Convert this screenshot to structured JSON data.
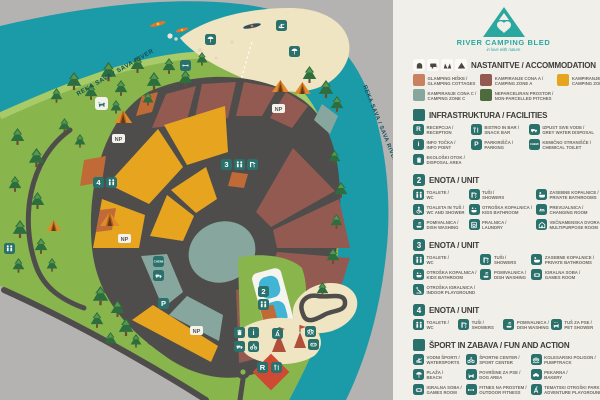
{
  "colors": {
    "gray": "#b5b3b1",
    "river": "#1b9aa8",
    "land": "#88b64c",
    "landlight": "#a6cb68",
    "sand": "#f0e5c3",
    "road": "#4e4d4b",
    "zonea": "#935a51",
    "zoneb": "#e7a51f",
    "zonec": "#87a79e",
    "glamping": "#c9815f",
    "nonparcelled": "#4e6b3d",
    "orangep": "#c06a38",
    "buildingred": "#ce4a33",
    "pool": "#43b5d4",
    "accent": "#2a716c",
    "legendbg": "#f1efe9",
    "header": "#3e3c38",
    "label": "#6f6b63",
    "treedark": "#2d6e3e",
    "treemid": "#57984d",
    "logo": "#2aa8a0",
    "riverlabel": "#0f4f5c"
  },
  "logo": {
    "title": "RIVER CAMPING BLED",
    "tagline": "in love with nature"
  },
  "map": {
    "river_label": "REKA SAVA / SAVA RIVER",
    "np": "NP",
    "markers": {
      "unit2": "2",
      "unit3": "3",
      "unit4": "4",
      "reception": "R",
      "parking": "P",
      "info": "i",
      "chemical": "CHEMI"
    }
  },
  "legend": {
    "accommodation": {
      "title": "NASTANITVE / ACCOMMODATION",
      "items": [
        {
          "line1": "GLAMPING HIŠKE /",
          "line2": "GLAMPING COTTAGES"
        },
        {
          "line1": "KAMPIRANJE CONA A /",
          "line2": "CAMPING ZONE A"
        },
        {
          "line1": "KAMPIRANJE CONA B /",
          "line2": "CAMPING ZONE B"
        },
        {
          "line1": "KAMPIRANJE CONA C /",
          "line2": "CAMPING ZONE C"
        },
        {
          "line1": "NEPARCELIRAN PROSTOR /",
          "line2": "NON-PARCELLED PITCHES"
        }
      ]
    },
    "facilities": {
      "title": "INFRASTRUKTURA / FACILITIES",
      "items": [
        {
          "line1": "RECEPCIJA /",
          "line2": "RECEPTION"
        },
        {
          "line1": "BISTRO IN BAR /",
          "line2": "SNACK BAR"
        },
        {
          "line1": "IZPUST SIVE VODE /",
          "line2": "GREY WATER DISPOSAL"
        },
        {
          "line1": "INFO TOČKA /",
          "line2": "INFO POINT"
        },
        {
          "line1": "PARKIRIŠČA /",
          "line2": "PARKING"
        },
        {
          "line1": "KEMIČNO STRANIŠČE /",
          "line2": "CHEMICAL TOILET"
        },
        {
          "line1": "EKOLOŠKI OTOK /",
          "line2": "DISPOSAL AREA"
        }
      ]
    },
    "unit2": {
      "number": "2",
      "title": "ENOTA / UNIT",
      "items": [
        {
          "line1": "TOALETE /",
          "line2": "WC"
        },
        {
          "line1": "TUŠI /",
          "line2": "SHOWERS"
        },
        {
          "line1": "ZASEBNE KOPALNICE /",
          "line2": "PRIVATE BATHROOMS"
        },
        {
          "line1": "TOALETA IN TUŠ /",
          "line2": "WC AND SHOWER"
        },
        {
          "line1": "OTROŠKA KOPALNICA /",
          "line2": "KIDS BATHROOM"
        },
        {
          "line1": "PREVIJALNICA /",
          "line2": "CHANGING ROOM"
        },
        {
          "line1": "POMIVALNICA /",
          "line2": "DISH WASHING"
        },
        {
          "line1": "PRALNICA /",
          "line2": "LAUNDRY"
        },
        {
          "line1": "VEČNAMENSKA DVORANA /",
          "line2": "MULTIPURPOSE ROOM"
        }
      ]
    },
    "unit3": {
      "number": "3",
      "title": "ENOTA / UNIT",
      "items": [
        {
          "line1": "TOALETE /",
          "line2": "WC"
        },
        {
          "line1": "TUŠI /",
          "line2": "SHOWERS"
        },
        {
          "line1": "ZASEBNE KOPALNICE /",
          "line2": "PRIVATE BATHROOMS"
        },
        {
          "line1": "OTROŠKA KOPALNICA /",
          "line2": "KIDS BATHROOM"
        },
        {
          "line1": "POMIVALNICA /",
          "line2": "DISH WASHING"
        },
        {
          "line1": "IGRALNA SOBA /",
          "line2": "GAMES ROOM"
        },
        {
          "line1": "OTROŠKA IGRALNICA /",
          "line2": "INDOOR PLAYGROUND"
        }
      ]
    },
    "unit4": {
      "number": "4",
      "title": "ENOTA / UNIT",
      "items": [
        {
          "line1": "TOALETE /",
          "line2": "WC"
        },
        {
          "line1": "TUŠI /",
          "line2": "SHOWERS"
        },
        {
          "line1": "POMIVALNICA /",
          "line2": "DISH WASHING"
        },
        {
          "line1": "TUŠ ZA PSE /",
          "line2": "PET SHOWER"
        }
      ]
    },
    "sport": {
      "title": "ŠPORT IN ZABAVA / FUN AND ACTION",
      "items": [
        {
          "line1": "VODNI ŠPORTI /",
          "line2": "WATERSPORTS"
        },
        {
          "line1": "ŠPORTNI CENTER /",
          "line2": "SPORT CENTER"
        },
        {
          "line1": "KOLESARSKI POLIGON /",
          "line2": "PUMPTRACK"
        },
        {
          "line1": "PLAŽA /",
          "line2": "BEACH"
        },
        {
          "line1": "POVRŠINE ZA PSE /",
          "line2": "DOG AREA"
        },
        {
          "line1": "PEKARNA /",
          "line2": "BAKERY"
        },
        {
          "line1": "IGRALNA SOBA /",
          "line2": "GAMES ROOM"
        },
        {
          "line1": "FITNES NA PROSTEM /",
          "line2": "OUTDOOR FITNESS"
        },
        {
          "line1": "TEMATSKI OTROŠKI PARK /",
          "line2": "ADVENTURE PLAYGROUND"
        }
      ]
    }
  }
}
